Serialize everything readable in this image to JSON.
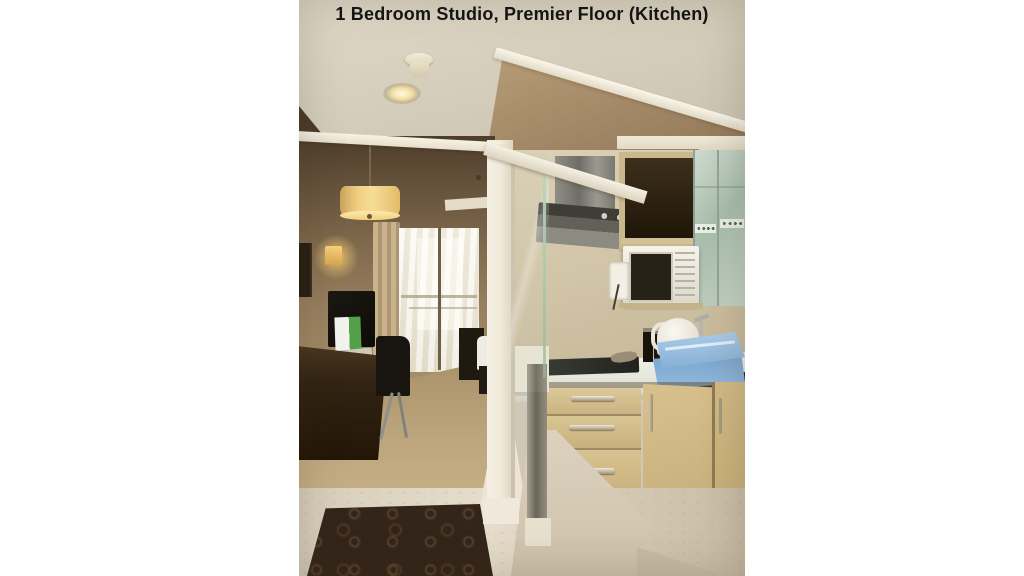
{
  "caption": "1 Bedroom Studio, Premier Floor (Kitchen)",
  "image": {
    "type": "photograph",
    "description": "Hotel studio apartment interior: hallway leading to a bedroom on the left and an open kitchen behind a glass partition on the right",
    "objects": [
      "ceiling recessed downlight",
      "smoke detector",
      "pendant drum lamp",
      "wall sconce",
      "framed picture",
      "TV on desk",
      "desk chair",
      "beige curtain",
      "sheer curtain",
      "balcony window",
      "bed",
      "nightstand",
      "stainless range hood",
      "open upper cabinet",
      "frosted glass cabinets",
      "white microwave",
      "power outlet",
      "electric kettle",
      "dark bottles",
      "glass cooktop",
      "stacked blue trays",
      "dark sink counter",
      "three-drawer cabinet",
      "cabinet doors",
      "white countertop",
      "glass partition",
      "marble floor",
      "dark patterned area rug",
      "tan carpet"
    ]
  },
  "palette": {
    "page_bg": "#ffffff",
    "caption_text": "#141414",
    "ceiling_cream": "#d6cfbe",
    "wall_tan": "#a98e68",
    "wood_dark": "#33241a",
    "cabinet_beige": "#d2bd8c",
    "frosted_glass": "#b9c9bc",
    "tray_blue": "#93badd",
    "rug_brown": "#34251a",
    "carpet_tan": "#b59c74",
    "marble": "#ddd3c2",
    "counter_white": "#eef0e8",
    "steel_gray": "#76766e",
    "lamp_glow": "#f2cd7c"
  }
}
